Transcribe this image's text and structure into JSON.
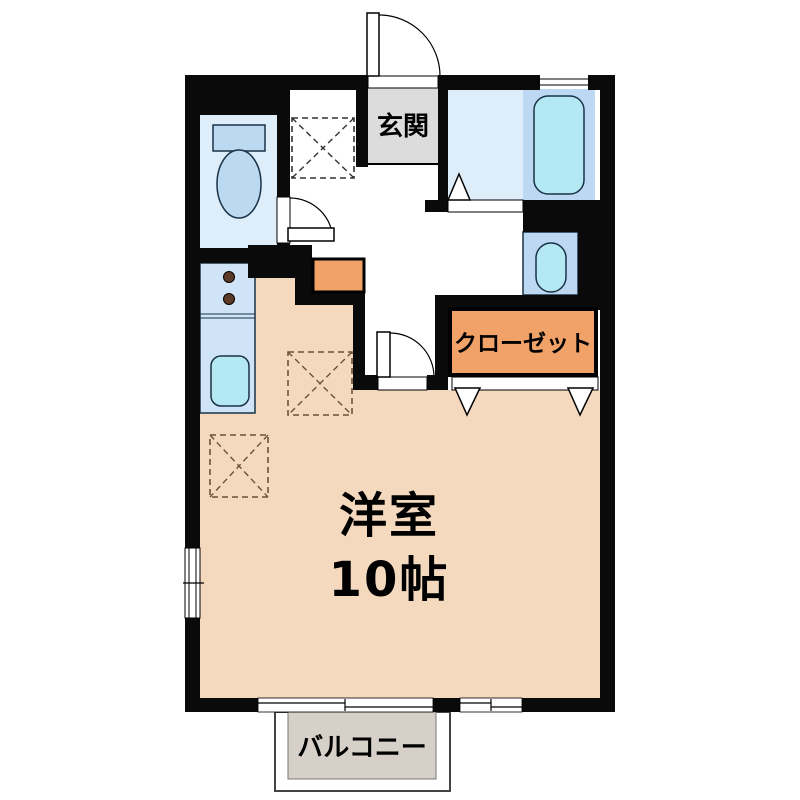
{
  "title": "1R apartment floor plan",
  "labels": {
    "entrance": "玄関",
    "closet": "クローゼット",
    "room_name": "洋室",
    "room_size": "10帖",
    "balcony": "バルコニー"
  },
  "colors": {
    "wall": "#0a0a0a",
    "room_floor": "#F5D9BE",
    "closet_orange": "#F0A268",
    "water_room_light": "#DEEDFA",
    "water_panel_blue": "#BDD8F2",
    "fixture_cyan": "#B4E8F2",
    "toilet_fixture_blue": "#BCD9F2",
    "kitchen_counter_blue": "#CFE4F6",
    "genkan_gray": "#DCDCDC",
    "balcony_gray": "#D7D0C9",
    "stove_knob_brown": "#5C3A28",
    "dashed_marker_brown": "#6E513B",
    "background": "#FFFFFF"
  }
}
